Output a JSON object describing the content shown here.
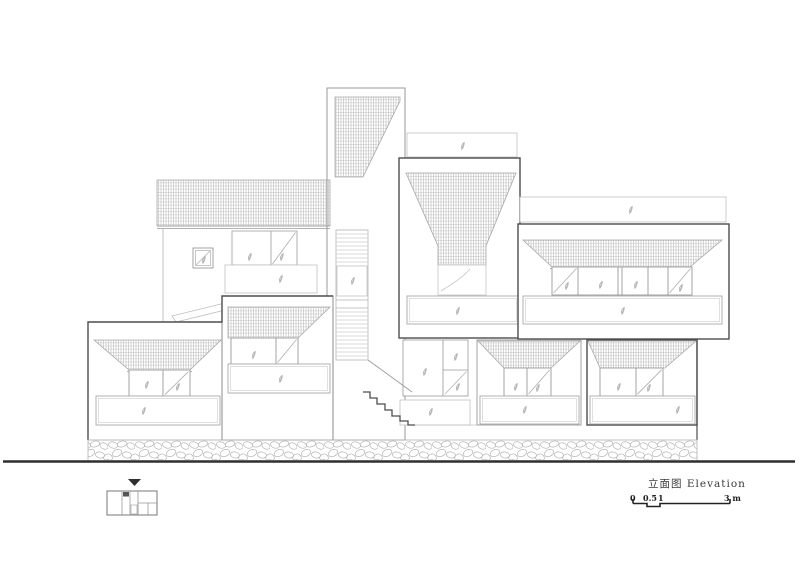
{
  "drawing": {
    "title": "立面图 Elevation",
    "type_label": "elevation-drawing"
  },
  "scale_bar": {
    "labels": [
      "0",
      "0.5",
      "1",
      "3 m"
    ],
    "unit": "m"
  },
  "palette": {
    "line_dark": "#4d4d4d",
    "line_medium": "#9a9a9a",
    "line_light": "#c6c6c6",
    "hatch": "#b8b8b8",
    "text": "#3a3a3a",
    "ground": "#2f2f2f"
  },
  "icons": {
    "plant": "plant-sprig-icon",
    "view_marker": "view-direction-marker",
    "key_plan": "key-plan-icon"
  }
}
